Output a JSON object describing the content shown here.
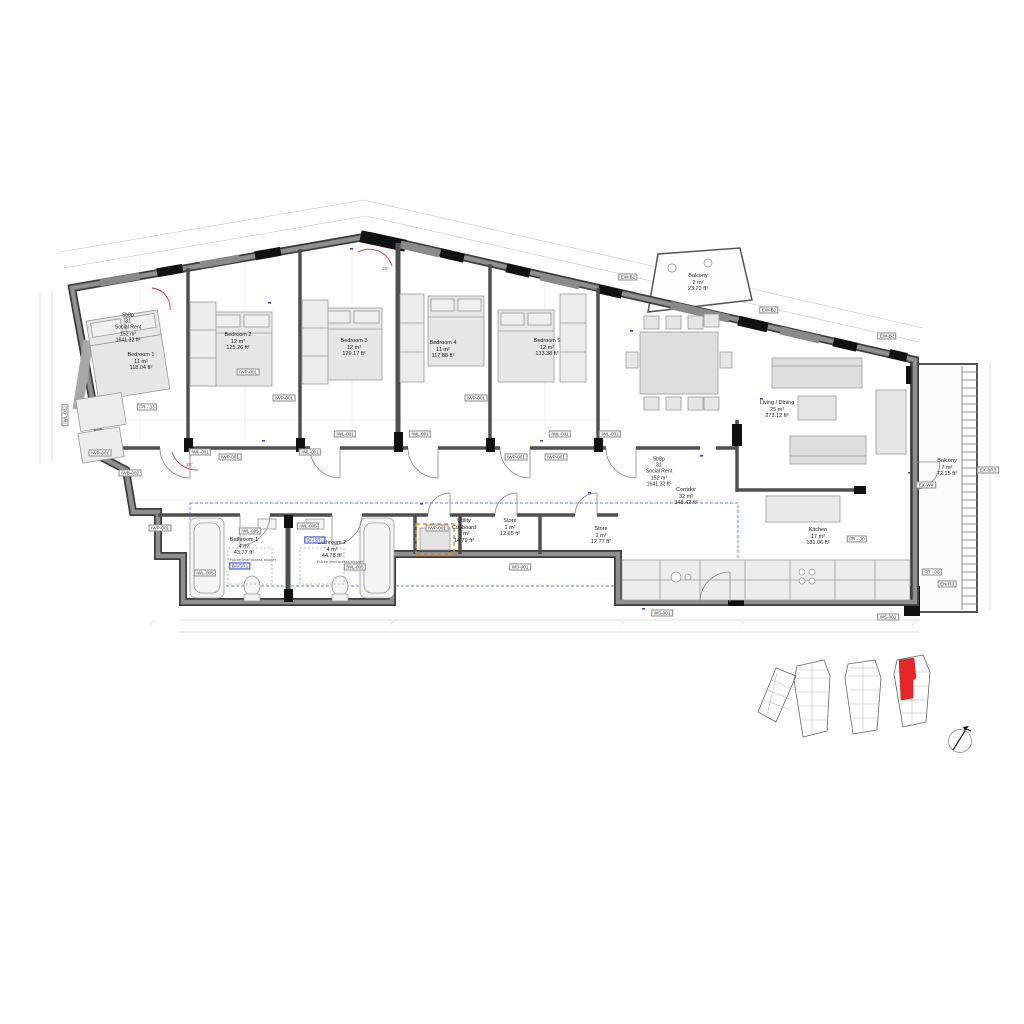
{
  "unit": {
    "type": "5b8p",
    "number": "31",
    "tenure": "Social Rent",
    "area_m2": "152 m²",
    "area_ft2": "1641.32 ft²"
  },
  "rooms": {
    "bedroom1": {
      "name": "Bedroom 1",
      "area_m2": "11 m²",
      "area_ft2": "118.04 ft²"
    },
    "bedroom2": {
      "name": "Bedroom 2",
      "area_m2": "12 m²",
      "area_ft2": "125.26 ft²"
    },
    "bedroom3": {
      "name": "Bedroom 3",
      "area_m2": "12 m²",
      "area_ft2": "129.17 ft²"
    },
    "bedroom4": {
      "name": "Bedroom 4",
      "area_m2": "11 m²",
      "area_ft2": "117.88 ft²"
    },
    "bedroom5": {
      "name": "Bedroom 5",
      "area_m2": "12 m²",
      "area_ft2": "133.38 ft²"
    },
    "living_dining": {
      "name": "Living / Dining",
      "area_m2": "25 m²",
      "area_ft2": "273.12 ft²"
    },
    "kitchen": {
      "name": "Kitchen",
      "area_m2": "17 m²",
      "area_ft2": "181.06 ft²"
    },
    "corridor": {
      "name": "Corridor",
      "area_m2": "32 m²",
      "area_ft2": "348.42 ft²"
    },
    "bathroom1": {
      "name": "Bathroom 1",
      "area_m2": "4 m²",
      "area_ft2": "43.77 ft²"
    },
    "bathroom2": {
      "name": "Bathroom 2",
      "area_m2": "4 m²",
      "area_ft2": "44.78 ft²"
    },
    "utility": {
      "line1": "Utility",
      "line2": "Cupboard",
      "area_m2": "1 m²",
      "area_ft2": "14.79 ft²"
    },
    "store1": {
      "name": "Store",
      "area_m2": "1 m²",
      "area_ft2": "12.65 ft²"
    },
    "store2": {
      "name": "Store",
      "area_m2": "1 m²",
      "area_ft2": "12.77 ft²"
    },
    "balcony_top": {
      "name": "Balcony",
      "area_m2": "2 m²",
      "area_ft2": "23.72 ft²"
    },
    "balcony_right": {
      "name": "Balcony",
      "area_m2": "7 m²",
      "area_ft2": "72.15 ft²"
    }
  },
  "notes": {
    "shower": "Future level access shower",
    "swing_angle": "18°"
  },
  "tags": [
    {
      "label": "EW-B2",
      "x": 628,
      "y": 277
    },
    {
      "label": "EW-B2",
      "x": 769,
      "y": 310
    },
    {
      "label": "EW-B2",
      "x": 887,
      "y": 336
    },
    {
      "label": "EX-W4",
      "x": 926,
      "y": 485
    },
    {
      "label": "EX-BR3",
      "x": 988,
      "y": 470
    },
    {
      "label": "FR - 33",
      "x": 147,
      "y": 407
    },
    {
      "label": "FR - 30",
      "x": 857,
      "y": 539
    },
    {
      "label": "FR - 03",
      "x": 932,
      "y": 572
    },
    {
      "label": "EN-R3",
      "x": 947,
      "y": 584
    },
    {
      "label": "WS-001",
      "x": 520,
      "y": 567
    },
    {
      "label": "WS-001",
      "x": 662,
      "y": 613
    },
    {
      "label": "WS-001",
      "x": 888,
      "y": 617
    },
    {
      "label": "IWP-001",
      "x": 100,
      "y": 453
    },
    {
      "label": "IWP-001",
      "x": 160,
      "y": 528
    },
    {
      "label": "IWP-001",
      "x": 248,
      "y": 372
    },
    {
      "label": "IWP-001",
      "x": 284,
      "y": 398
    },
    {
      "label": "IWP-001",
      "x": 476,
      "y": 398
    },
    {
      "label": "IWP-001",
      "x": 230,
      "y": 457
    },
    {
      "label": "IWP-001",
      "x": 516,
      "y": 457
    },
    {
      "label": "IWP-001",
      "x": 556,
      "y": 457
    },
    {
      "label": "IWP-001",
      "x": 437,
      "y": 528
    },
    {
      "label": "IWL-001",
      "x": 200,
      "y": 452
    },
    {
      "label": "IWL-001",
      "x": 310,
      "y": 452
    },
    {
      "label": "IWL-001",
      "x": 345,
      "y": 434
    },
    {
      "label": "IWL-001",
      "x": 420,
      "y": 434
    },
    {
      "label": "IWL-001",
      "x": 560,
      "y": 434
    },
    {
      "label": "IWL-001",
      "x": 610,
      "y": 434
    },
    {
      "label": "IWL-005",
      "x": 205,
      "y": 573
    },
    {
      "label": "IWL-005",
      "x": 250,
      "y": 531
    },
    {
      "label": "IWL-005",
      "x": 308,
      "y": 526
    },
    {
      "label": "IWL-005",
      "x": 355,
      "y": 567
    },
    {
      "label": "IWB-002",
      "x": 130,
      "y": 473
    },
    {
      "label": "IWL-002",
      "x": 65,
      "y": 415,
      "variant": "rot"
    },
    {
      "label": "BA/SR1",
      "x": 240,
      "y": 566,
      "variant": "blue"
    },
    {
      "label": "BA/SR1",
      "x": 315,
      "y": 540,
      "variant": "blue"
    }
  ],
  "colors": {
    "wall_dark": "#3d3d3d",
    "wall_core": "#8f8f8f",
    "highlight_red": "#e8262a",
    "tag_blue": "#2a35c8",
    "dim_blue": "#3a45cc",
    "utility_orange": "#f28c1e"
  }
}
